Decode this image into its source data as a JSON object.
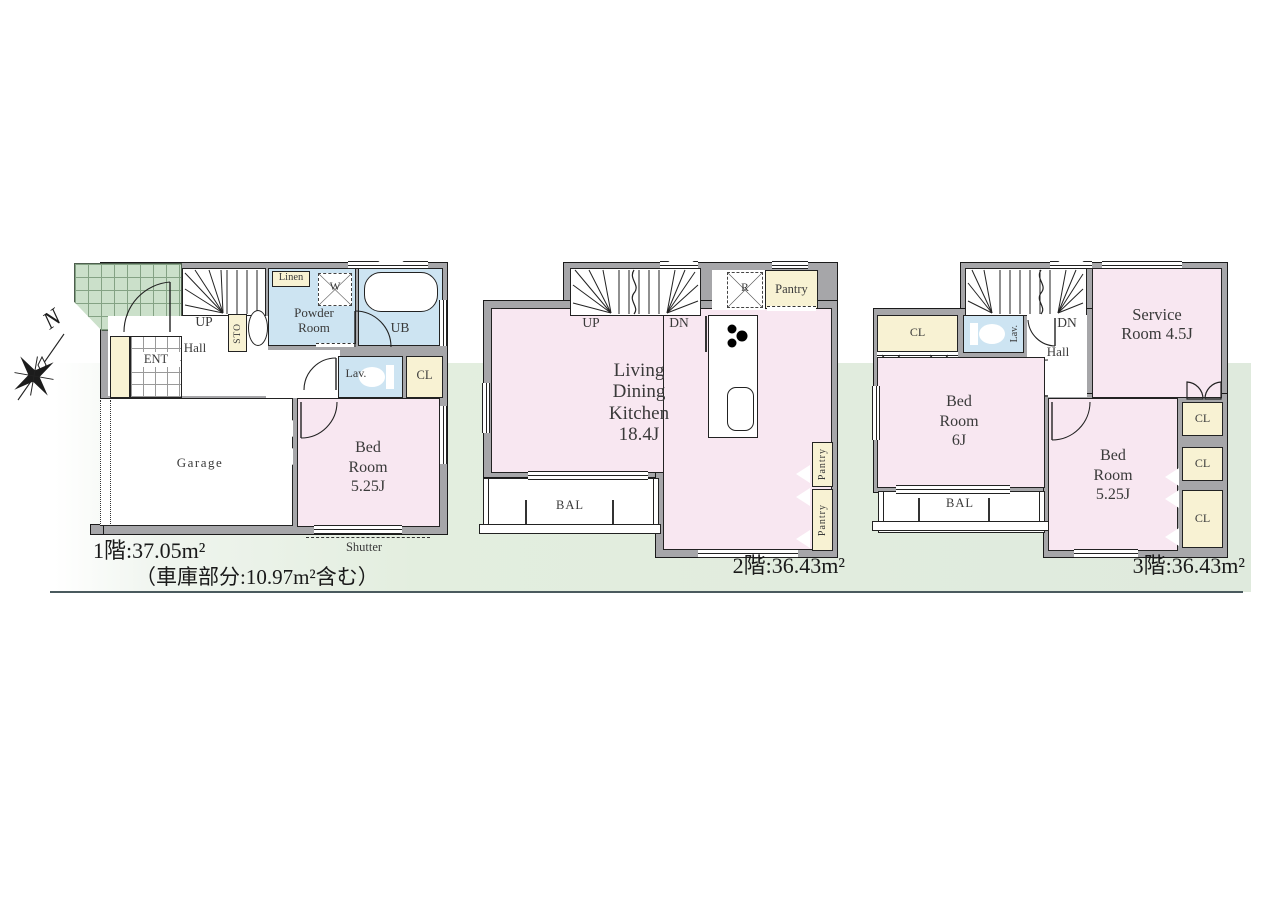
{
  "compass": {
    "north_label": "N"
  },
  "floor1": {
    "caption_line1": "1階:37.05m²",
    "caption_line2": "（車庫部分:10.97m²含む）",
    "rooms": {
      "stairs_up": "UP",
      "hall": "Hall",
      "entrance": "ENT",
      "storage": "STO",
      "linen": "Linen",
      "washer": "W",
      "powder_room": "Powder Room",
      "unit_bath": "UB",
      "lavatory": "Lav.",
      "closet": "CL",
      "garage": "Garage",
      "bedroom": "Bed Room 5.25J",
      "shutter": "Shutter"
    }
  },
  "floor2": {
    "caption": "2階:36.43m²",
    "rooms": {
      "stairs_up": "UP",
      "stairs_down": "DN",
      "refrigerator": "R",
      "pantry": "Pantry",
      "ldk": "Living Dining Kitchen 18.4J",
      "balcony": "BAL",
      "pantry_side_upper": "Pantry",
      "pantry_side_lower": "Pantry"
    }
  },
  "floor3": {
    "caption": "3階:36.43m²",
    "rooms": {
      "stairs_down": "DN",
      "closet_upper": "CL",
      "lavatory": "Lav.",
      "hall": "Hall",
      "service_room": "Service Room 4.5J",
      "bedroom_6j": "Bed Room 6J",
      "balcony": "BAL",
      "bedroom_525j": "Bed Room 5.25J",
      "closet_1": "CL",
      "closet_2": "CL",
      "closet_3": "CL"
    }
  }
}
